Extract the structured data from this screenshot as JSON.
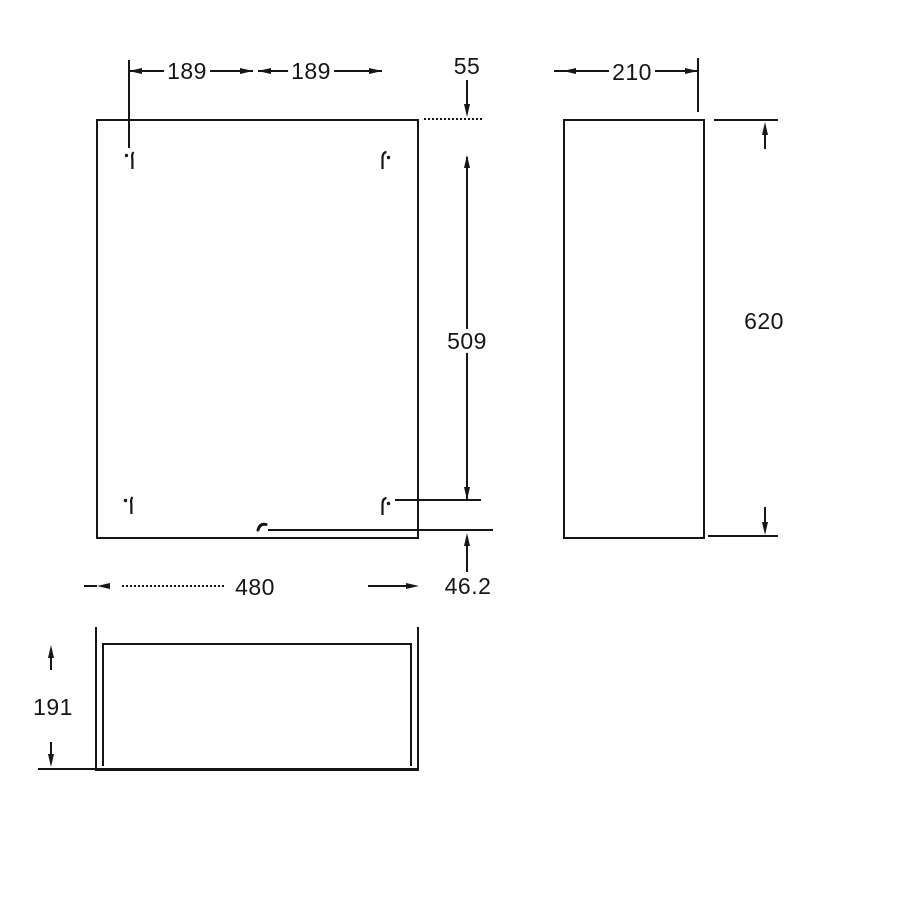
{
  "drawing": {
    "type": "technical-dimension-drawing",
    "background_color": "#ffffff",
    "line_color": "#161616",
    "views": {
      "front": {
        "name": "front view"
      },
      "side": {
        "name": "side view"
      },
      "bottom": {
        "name": "bottom view"
      }
    },
    "dims": {
      "hole_spacing_left": "189",
      "hole_spacing_right": "189",
      "top_offset": "55",
      "depth": "210",
      "hole_vertical_span": "509",
      "height": "620",
      "bottom_offset": "46.2",
      "width": "480",
      "bottom_depth": "191"
    }
  }
}
